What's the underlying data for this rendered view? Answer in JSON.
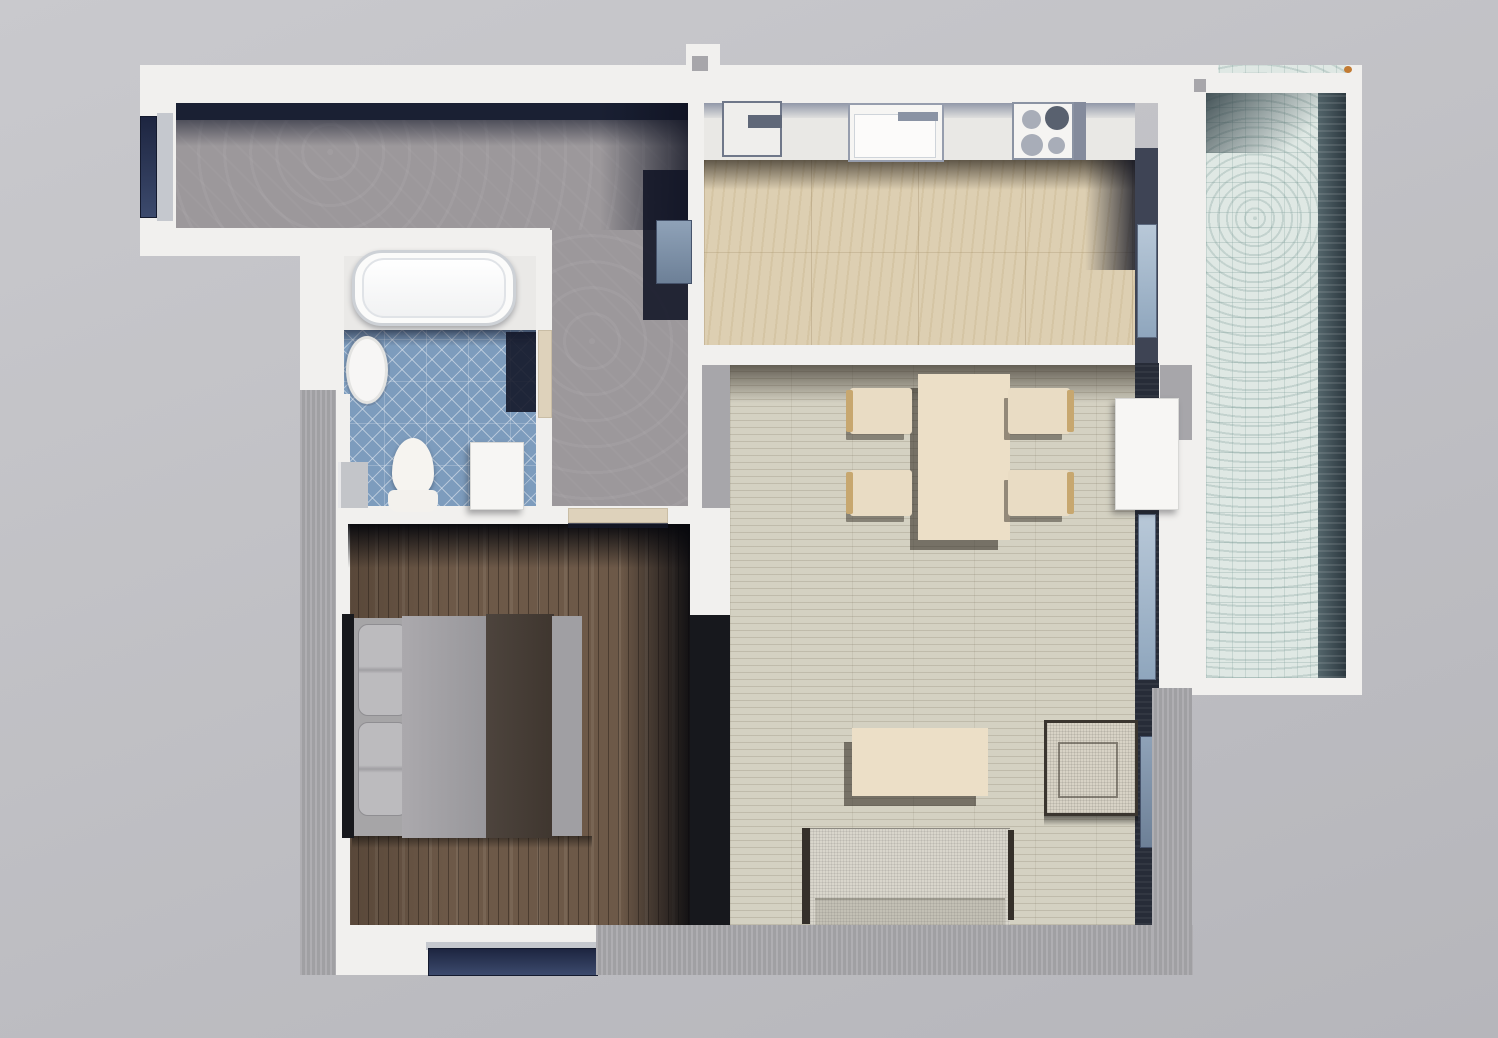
{
  "app": {
    "type": "3d-floor-plan-render",
    "view": "top-down-apartment"
  },
  "canvas": {
    "width": 1498,
    "height": 1038
  },
  "palette": {
    "bg1": "#c9c9cd",
    "bg2": "#b6b6bb",
    "wall": "#f1f0ee",
    "ledge": "#a9a8ac",
    "divider": "#17181d",
    "walldark": "#272c38",
    "navy": "#1a2033",
    "sill": "#c5c8ce",
    "threshold": "#ded2bb",
    "hall": "#9c989b",
    "bathtile": "#7d9cbd",
    "kitchen": "#ddcfb2",
    "living": "#d4d1c2",
    "bedroom": "#6d5948",
    "balcony": "#dfe8e4",
    "counter": "#e9e8e5",
    "cream": "#ecdfc7",
    "wood": "#c7a76f",
    "sofa": "#d9d6cc",
    "mattress": "#a6a5a7",
    "headboard": "#17181c"
  },
  "rooms": [
    {
      "name": "hallway"
    },
    {
      "name": "bathroom"
    },
    {
      "name": "bedroom"
    },
    {
      "name": "kitchen"
    },
    {
      "name": "living-dining"
    },
    {
      "name": "balcony"
    }
  ],
  "elements": [
    {
      "name": "hallway-floor-horizontal",
      "room": "hallway",
      "cls": "floor-hall",
      "rect": [
        176,
        100,
        514,
        130
      ]
    },
    {
      "name": "hallway-floor-vertical",
      "room": "hallway",
      "cls": "floor-hall",
      "rect": [
        550,
        230,
        140,
        278
      ]
    },
    {
      "name": "bathtub-alcove-floor",
      "room": "bathroom",
      "cls": "alcove",
      "rect": [
        342,
        254,
        194,
        80
      ]
    },
    {
      "name": "bathroom-tile-floor",
      "room": "bathroom",
      "cls": "floor-bath",
      "rect": [
        342,
        330,
        196,
        178
      ]
    },
    {
      "name": "kitchen-counter-run",
      "room": "kitchen",
      "cls": "counter",
      "rect": [
        704,
        103,
        431,
        57
      ]
    },
    {
      "name": "kitchen-counter-edge-band",
      "room": "kitchen",
      "cls": "counter-band",
      "rect": [
        704,
        103,
        431,
        15
      ]
    },
    {
      "name": "kitchen-floor",
      "room": "kitchen",
      "cls": "floor-kitchen",
      "rect": [
        704,
        160,
        431,
        186
      ]
    },
    {
      "name": "living-room-floor",
      "room": "living-dining",
      "cls": "floor-living",
      "rect": [
        730,
        363,
        405,
        562
      ]
    },
    {
      "name": "bedroom-floor",
      "room": "bedroom",
      "cls": "floor-bedroom",
      "rect": [
        348,
        524,
        342,
        401
      ]
    },
    {
      "name": "balcony-floor",
      "room": "balcony",
      "cls": "floor-balcony",
      "rect": [
        1206,
        65,
        140,
        613
      ]
    },
    {
      "name": "balcony-shadow-band",
      "room": "balcony",
      "cls": "balcony-dark",
      "rect": [
        1318,
        93,
        28,
        585
      ]
    },
    {
      "name": "balcony-top-shadow",
      "room": "balcony",
      "cls": "balcony-top-shade",
      "rect": [
        1206,
        93,
        140,
        60
      ]
    },
    {
      "name": "hallway-north-wall-shadow",
      "room": "hallway",
      "cls": "navy-solid",
      "rect": [
        176,
        100,
        514,
        20
      ]
    },
    {
      "name": "hallway-north-shadow-fade",
      "room": "hallway",
      "cls": "shade-down",
      "rect": [
        176,
        120,
        514,
        26
      ]
    },
    {
      "name": "hallway-east-corner-shadow",
      "room": "hallway",
      "cls": "shade-to-right",
      "rect": [
        600,
        100,
        90,
        130
      ]
    },
    {
      "name": "hallway-corner-shadow-blob",
      "room": "hallway",
      "cls": "navy-soft",
      "rect": [
        643,
        170,
        47,
        150
      ]
    },
    {
      "name": "kitchen-under-counter-shadow",
      "room": "kitchen",
      "cls": "shade-strong-down",
      "rect": [
        704,
        160,
        431,
        30
      ]
    },
    {
      "name": "kitchen-east-floor-shadow",
      "room": "kitchen",
      "cls": "shade-to-right",
      "rect": [
        1085,
        160,
        50,
        110
      ]
    },
    {
      "name": "living-north-shadow",
      "room": "living-dining",
      "cls": "shade-strong-down",
      "rect": [
        730,
        363,
        405,
        40
      ]
    },
    {
      "name": "bathroom-tile-top-shadow",
      "room": "bathroom",
      "cls": "shade-down",
      "rect": [
        342,
        330,
        196,
        16
      ]
    },
    {
      "name": "bathroom-door-shadow-wedge",
      "room": "bathroom",
      "cls": "navy-soft",
      "rect": [
        506,
        332,
        32,
        80
      ]
    },
    {
      "name": "north-outer-wall",
      "cls": "wall",
      "rect": [
        140,
        65,
        1052,
        38
      ]
    },
    {
      "name": "north-wall-stub",
      "cls": "wall",
      "rect": [
        686,
        44,
        34,
        24
      ]
    },
    {
      "name": "north-stub-notch",
      "cls": "ledge-smooth",
      "rect": [
        692,
        56,
        16,
        15
      ]
    },
    {
      "name": "west-outer-wall",
      "cls": "wall",
      "rect": [
        140,
        65,
        36,
        170
      ]
    },
    {
      "name": "hallway-window-glass",
      "cls": "glass-dark",
      "rect": [
        140,
        116,
        17,
        102
      ]
    },
    {
      "name": "hallway-window-sill",
      "cls": "sill",
      "rect": [
        157,
        113,
        16,
        108
      ]
    },
    {
      "name": "hallway-south-wall",
      "cls": "wall",
      "rect": [
        140,
        228,
        410,
        28
      ]
    },
    {
      "name": "bathroom-west-wall-upper",
      "cls": "wall",
      "rect": [
        300,
        254,
        44,
        140
      ]
    },
    {
      "name": "bathroom-west-wall-lower",
      "cls": "wall",
      "rect": [
        334,
        394,
        16,
        531
      ]
    },
    {
      "name": "bathroom-east-wall",
      "cls": "wall",
      "rect": [
        536,
        230,
        16,
        278
      ]
    },
    {
      "name": "bathroom-south-wall",
      "cls": "wall",
      "rect": [
        300,
        506,
        420,
        18
      ]
    },
    {
      "name": "kitchen-west-wall",
      "cls": "wall",
      "rect": [
        688,
        100,
        16,
        263
      ]
    },
    {
      "name": "entry-gray-wall-stub",
      "cls": "ledge-smooth",
      "rect": [
        702,
        363,
        28,
        145
      ]
    },
    {
      "name": "living-west-wall-upper",
      "cls": "wall",
      "rect": [
        688,
        363,
        14,
        162
      ]
    },
    {
      "name": "door-jamb-wall",
      "cls": "wall",
      "rect": [
        690,
        508,
        40,
        110
      ]
    },
    {
      "name": "bedroom-living-divider-wall",
      "cls": "divider",
      "rect": [
        690,
        615,
        40,
        313
      ]
    },
    {
      "name": "kitchen-south-wall",
      "cls": "wall",
      "rect": [
        688,
        345,
        447,
        20
      ]
    },
    {
      "name": "kitchen-east-inner-wall",
      "cls": "wall-dark-soft",
      "rect": [
        1135,
        148,
        23,
        217
      ]
    },
    {
      "name": "kitchen-window-glass",
      "cls": "glass-light",
      "rect": [
        1137,
        224,
        20,
        114
      ]
    },
    {
      "name": "kitchen-east-outer-wall",
      "cls": "wall",
      "rect": [
        1158,
        65,
        34,
        623
      ]
    },
    {
      "name": "east-wall-shadow-patch",
      "cls": "ledge-smooth",
      "rect": [
        1160,
        365,
        32,
        75
      ]
    },
    {
      "name": "balcony-west-wall",
      "cls": "wall",
      "rect": [
        1192,
        93,
        14,
        585
      ]
    },
    {
      "name": "balcony-north-wall",
      "cls": "wall",
      "rect": [
        1192,
        73,
        164,
        20
      ]
    },
    {
      "name": "balcony-north-stub",
      "cls": "wall",
      "rect": [
        1192,
        65,
        26,
        14
      ]
    },
    {
      "name": "balcony-notch",
      "cls": "ledge-smooth",
      "rect": [
        1194,
        79,
        12,
        13
      ]
    },
    {
      "name": "balcony-east-wall",
      "cls": "wall",
      "rect": [
        1346,
        65,
        16,
        629
      ]
    },
    {
      "name": "balcony-south-wall",
      "cls": "wall",
      "rect": [
        1192,
        678,
        170,
        17
      ]
    },
    {
      "name": "balcony-corner-marker",
      "cls": "marker",
      "rect": [
        1344,
        66,
        8,
        7
      ]
    },
    {
      "name": "living-east-wall-dark",
      "cls": "wall-dark",
      "rect": [
        1135,
        363,
        24,
        562
      ]
    },
    {
      "name": "balcony-door-glass",
      "cls": "glass-light",
      "rect": [
        1138,
        514,
        18,
        166
      ]
    },
    {
      "name": "living-window-glass",
      "cls": "glass-mid",
      "rect": [
        1140,
        736,
        16,
        112
      ]
    },
    {
      "name": "bedroom-south-wall",
      "cls": "wall",
      "rect": [
        334,
        925,
        262,
        50
      ]
    },
    {
      "name": "bedroom-window-sill",
      "cls": "sill",
      "rect": [
        426,
        942,
        174,
        8
      ]
    },
    {
      "name": "bedroom-window-glass",
      "cls": "glass-dark",
      "rect": [
        428,
        948,
        170,
        28
      ]
    },
    {
      "name": "south-ledge",
      "cls": "ledge",
      "rect": [
        596,
        925,
        597,
        50
      ]
    },
    {
      "name": "east-ledge",
      "cls": "ledge",
      "rect": [
        1152,
        688,
        40,
        287
      ]
    },
    {
      "name": "west-ledge",
      "cls": "ledge",
      "rect": [
        300,
        390,
        36,
        585
      ]
    },
    {
      "name": "bedroom-north-shadow",
      "room": "bedroom",
      "cls": "shade-bed-down",
      "rect": [
        348,
        524,
        342,
        44
      ]
    },
    {
      "name": "bedroom-east-shadow",
      "room": "bedroom",
      "cls": "shade-bed-right",
      "rect": [
        620,
        524,
        70,
        401
      ]
    },
    {
      "name": "bathtub",
      "room": "bathroom",
      "cls": "tub",
      "rect": [
        352,
        250,
        164,
        76
      ]
    },
    {
      "name": "bathtub-inner-rim",
      "room": "bathroom",
      "cls": "tub-inner",
      "rect": [
        362,
        258,
        144,
        60
      ]
    },
    {
      "name": "bathroom-sink",
      "room": "bathroom",
      "cls": "oval-sink",
      "rect": [
        346,
        336,
        42,
        68
      ]
    },
    {
      "name": "toilet-bowl",
      "room": "bathroom",
      "cls": "toilet-bowl",
      "rect": [
        392,
        438,
        42,
        58
      ]
    },
    {
      "name": "toilet-base",
      "room": "bathroom",
      "cls": "toilet-base",
      "rect": [
        388,
        490,
        50,
        22
      ]
    },
    {
      "name": "washing-machine",
      "room": "bathroom",
      "cls": "white-box",
      "rect": [
        470,
        442,
        54,
        68
      ]
    },
    {
      "name": "bathroom-side-cabinet",
      "room": "bathroom",
      "cls": "gray-box",
      "rect": [
        338,
        462,
        30,
        46
      ]
    },
    {
      "name": "bathroom-door-threshold",
      "room": "bathroom",
      "cls": "threshold",
      "rect": [
        538,
        330,
        14,
        88
      ]
    },
    {
      "name": "leaning-glass-panel",
      "room": "hallway",
      "cls": "glass-mid",
      "rect": [
        656,
        220,
        36,
        64
      ]
    },
    {
      "name": "bedroom-door-threshold",
      "room": "bedroom",
      "cls": "threshold",
      "rect": [
        568,
        508,
        100,
        15
      ]
    },
    {
      "name": "bedroom-door-shadow-line",
      "room": "bedroom",
      "cls": "threshold-line",
      "rect": [
        568,
        523,
        100,
        5
      ]
    },
    {
      "name": "kitchen-corner-cabinet",
      "room": "kitchen",
      "cls": "cabinet",
      "rect": [
        722,
        101,
        60,
        56
      ]
    },
    {
      "name": "kitchen-cabinet-appliance",
      "room": "kitchen",
      "cls": "cabinet-bar",
      "rect": [
        748,
        115,
        34,
        13
      ]
    },
    {
      "name": "kitchen-sink-unit",
      "room": "kitchen",
      "cls": "ksink",
      "rect": [
        848,
        103,
        96,
        59
      ]
    },
    {
      "name": "kitchen-sink-basin",
      "room": "kitchen",
      "cls": "ksink-basin",
      "rect": [
        854,
        114,
        82,
        44
      ]
    },
    {
      "name": "kitchen-faucet",
      "room": "kitchen",
      "cls": "faucet",
      "rect": [
        898,
        112,
        40,
        9
      ]
    },
    {
      "name": "stove",
      "room": "kitchen",
      "cls": "stove",
      "rect": [
        1012,
        102,
        62,
        58
      ]
    },
    {
      "name": "stove-side-band",
      "room": "kitchen",
      "cls": "stove-band",
      "rect": [
        1074,
        102,
        12,
        58
      ]
    },
    {
      "name": "stove-burner-1",
      "room": "kitchen",
      "cls": "burner",
      "rect": [
        1022,
        110,
        19,
        19
      ]
    },
    {
      "name": "stove-burner-2",
      "room": "kitchen",
      "cls": "burner-dark",
      "rect": [
        1045,
        106,
        24,
        24
      ]
    },
    {
      "name": "stove-burner-3",
      "room": "kitchen",
      "cls": "burner",
      "rect": [
        1021,
        134,
        22,
        22
      ]
    },
    {
      "name": "stove-burner-4",
      "room": "kitchen",
      "cls": "burner",
      "rect": [
        1048,
        137,
        17,
        17
      ]
    },
    {
      "name": "dining-table",
      "room": "living-dining",
      "cls": "table",
      "rect": [
        918,
        374,
        92,
        166
      ]
    },
    {
      "name": "dining-chair-1",
      "room": "living-dining",
      "cls": "chair",
      "rect": [
        850,
        388,
        62,
        46
      ]
    },
    {
      "name": "dining-chair-2",
      "room": "living-dining",
      "cls": "chair",
      "rect": [
        850,
        470,
        62,
        46
      ]
    },
    {
      "name": "dining-chair-3",
      "room": "living-dining",
      "cls": "chair",
      "rect": [
        1008,
        388,
        62,
        46
      ]
    },
    {
      "name": "dining-chair-4",
      "room": "living-dining",
      "cls": "chair",
      "rect": [
        1008,
        470,
        62,
        46
      ]
    },
    {
      "name": "chair-arm-1",
      "room": "living-dining",
      "cls": "chair-arm",
      "rect": [
        846,
        390,
        7,
        42
      ]
    },
    {
      "name": "chair-arm-2",
      "room": "living-dining",
      "cls": "chair-arm",
      "rect": [
        846,
        472,
        7,
        42
      ]
    },
    {
      "name": "chair-arm-3",
      "room": "living-dining",
      "cls": "chair-arm",
      "rect": [
        1067,
        390,
        7,
        42
      ]
    },
    {
      "name": "chair-arm-4",
      "room": "living-dining",
      "cls": "chair-arm",
      "rect": [
        1067,
        472,
        7,
        42
      ]
    },
    {
      "name": "tall-cabinet",
      "room": "living-dining",
      "cls": "white-box",
      "rect": [
        1115,
        398,
        64,
        112
      ]
    },
    {
      "name": "coffee-table",
      "room": "living-dining",
      "cls": "table",
      "rect": [
        852,
        728,
        136,
        68
      ]
    },
    {
      "name": "sofa-left-arm",
      "room": "living-dining",
      "cls": "sofa-edge",
      "rect": [
        802,
        828,
        8,
        96
      ]
    },
    {
      "name": "sofa-body",
      "room": "living-dining",
      "cls": "sofa-body",
      "rect": [
        810,
        828,
        200,
        97
      ]
    },
    {
      "name": "sofa-right-arm",
      "room": "living-dining",
      "cls": "sofa-edge",
      "rect": [
        1008,
        830,
        6,
        90
      ]
    },
    {
      "name": "sofa-seat-band",
      "room": "living-dining",
      "cls": "sofa-seat",
      "rect": [
        815,
        898,
        190,
        27
      ]
    },
    {
      "name": "armchair",
      "room": "living-dining",
      "cls": "armchair",
      "rect": [
        1044,
        720,
        94,
        96
      ]
    },
    {
      "name": "armchair-seat",
      "room": "living-dining",
      "cls": "armchair-inner",
      "rect": [
        1058,
        742,
        60,
        56
      ]
    },
    {
      "name": "armchair-shadow",
      "room": "living-dining",
      "cls": "shadow-strip",
      "rect": [
        1044,
        816,
        94,
        10
      ]
    },
    {
      "name": "bed-shadow",
      "room": "bedroom",
      "cls": "shadow-strip",
      "rect": [
        352,
        836,
        240,
        12
      ]
    },
    {
      "name": "bed-headboard",
      "room": "bedroom",
      "cls": "headboard",
      "rect": [
        342,
        614,
        12,
        224
      ]
    },
    {
      "name": "bed-mattress",
      "room": "bedroom",
      "cls": "mattress",
      "rect": [
        354,
        618,
        228,
        218
      ]
    },
    {
      "name": "bed-pillow-top",
      "room": "bedroom",
      "cls": "pillow",
      "rect": [
        358,
        624,
        50,
        92
      ]
    },
    {
      "name": "bed-pillow-bottom",
      "room": "bedroom",
      "cls": "pillow",
      "rect": [
        358,
        722,
        50,
        94
      ]
    },
    {
      "name": "bed-duvet",
      "room": "bedroom",
      "cls": "duvet",
      "rect": [
        402,
        616,
        88,
        222
      ]
    },
    {
      "name": "bed-throw-runner",
      "room": "bedroom",
      "cls": "throw",
      "rect": [
        486,
        614,
        68,
        224
      ]
    },
    {
      "name": "bed-foot-strip",
      "room": "bedroom",
      "cls": "bedfoot",
      "rect": [
        552,
        616,
        30,
        220
      ]
    }
  ]
}
